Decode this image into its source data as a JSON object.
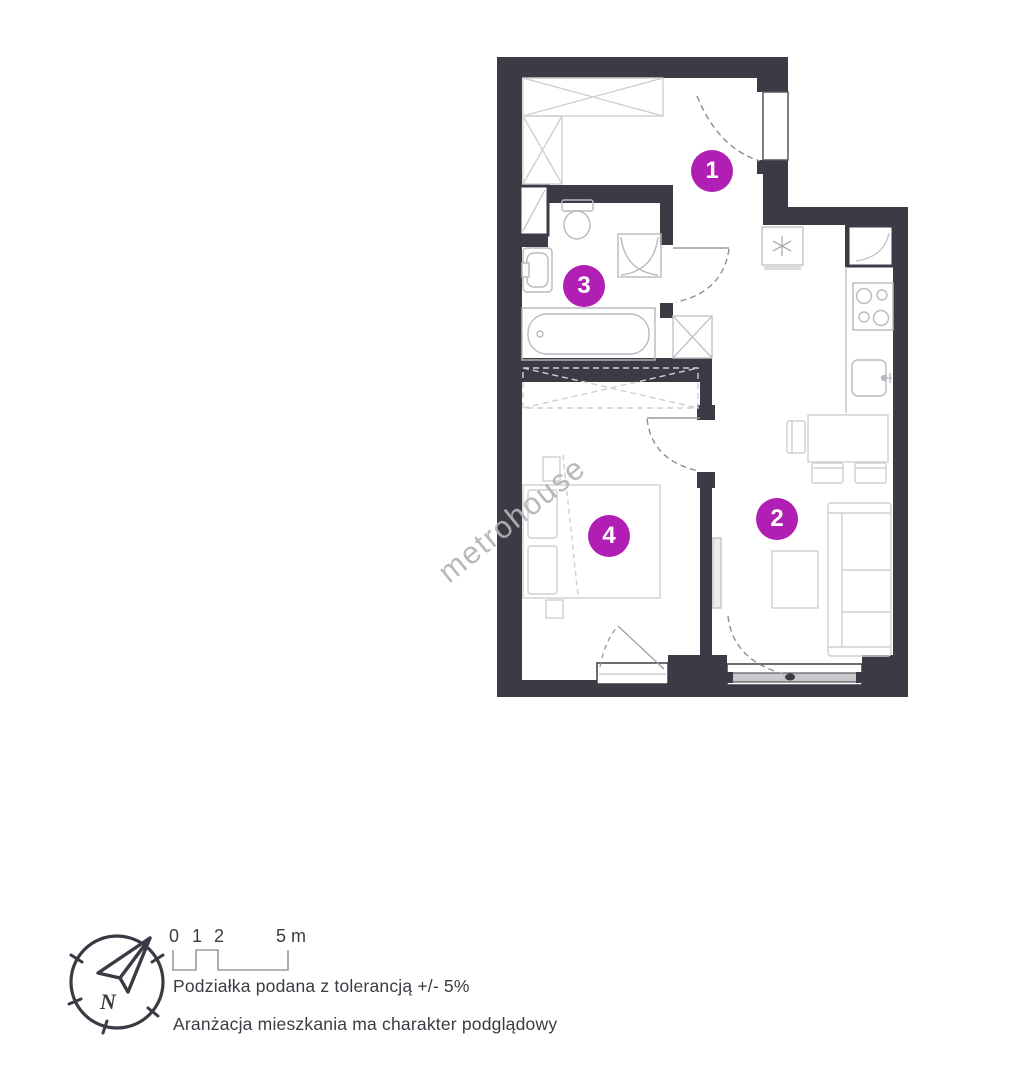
{
  "watermark": {
    "text": "metrohouse"
  },
  "plan": {
    "room_labels": [
      {
        "number": "1"
      },
      {
        "number": "2"
      },
      {
        "number": "3"
      },
      {
        "number": "4"
      }
    ]
  },
  "legend": {
    "compass_letter": "N",
    "scale_labels": [
      "0",
      "1",
      "2",
      "5 m"
    ],
    "tolerance_note": "Podziałka podana z tolerancją +/- 5%",
    "arrangement_note": "Aranżacja mieszkania ma charakter podglądowy"
  },
  "colors": {
    "accent": "#b01eb4",
    "wall": "#3b3b46",
    "furniture": "#cfcfd4",
    "fixture": "#b9b9bf",
    "door": "#8d8d94",
    "text": "#3b3b44",
    "watermark": "#b4b4b4",
    "glazing": "#c9c9cc",
    "scalebar": "#9b9b9b"
  }
}
